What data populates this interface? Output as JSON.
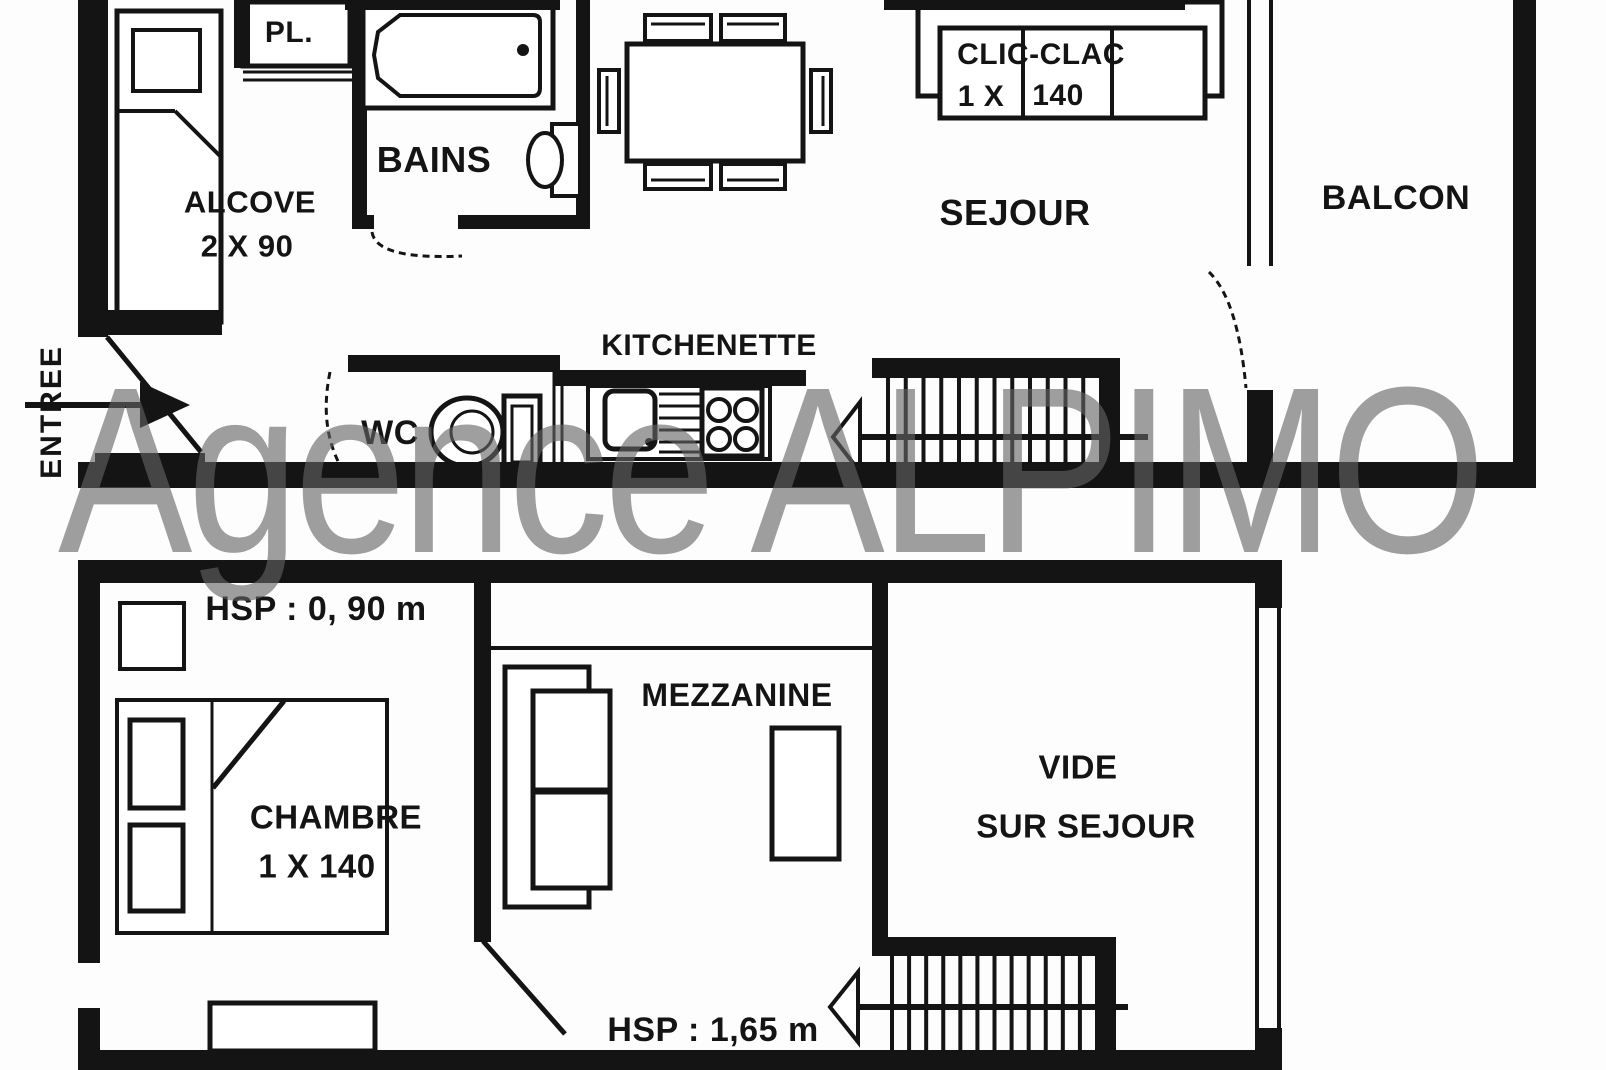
{
  "watermark_text": "Agence ALPIMO",
  "colors": {
    "ink": "#141414",
    "paper": "#fdfdfd",
    "watermark": "rgba(100,100,100,0.62)"
  },
  "upper_floor": {
    "entree": "ENTREE",
    "alcove_label": "ALCOVE",
    "alcove_dim": "2 X 90",
    "placard": "PL.",
    "bains": "BAINS",
    "wc": "WC",
    "kitchenette": "KITCHENETTE",
    "sejour": "SEJOUR",
    "clic_clac": "CLIC-CLAC",
    "clic_clac_dim_a": "1 X",
    "clic_clac_dim_b": "140",
    "balcon": "BALCON"
  },
  "lower_floor": {
    "hsp_low": "HSP : 0, 90 m",
    "chambre": "CHAMBRE",
    "chambre_dim": "1 X 140",
    "mezzanine": "MEZZANINE",
    "vide_line1": "VIDE",
    "vide_line2": "SUR SEJOUR",
    "hsp_high": "HSP : 1,65 m"
  }
}
